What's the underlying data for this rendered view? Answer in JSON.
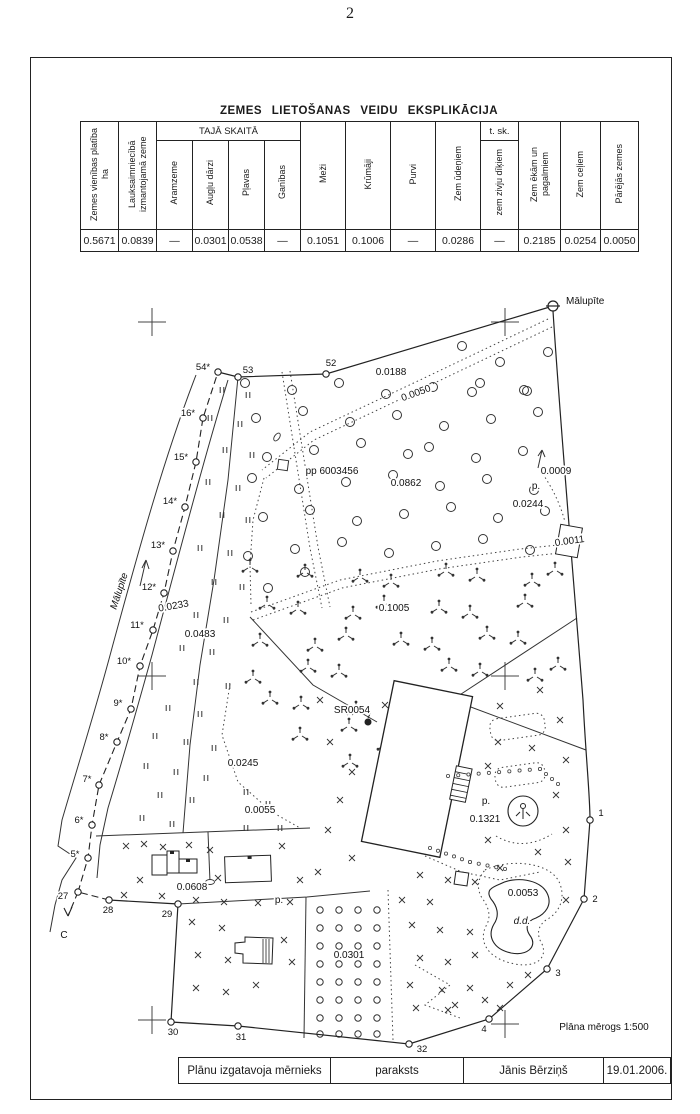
{
  "page": {
    "number": "2"
  },
  "explication": {
    "title": "ZEMES LIETOŠANAS VEIDU EKSPLIKĀCIJA",
    "col_platiba": "Zemes vienības platība ha",
    "col_lauksaimnieciba": "Lauksaimniecībā izmantojamā zeme",
    "group_taja_skaita": "TAJĀ SKAITĀ",
    "col_aramzeme": "Aramzeme",
    "col_auglu_darzi": "Augļu dārzi",
    "col_plavas": "Pļavas",
    "col_ganibas": "Ganības",
    "col_mezi": "Meži",
    "col_krumaji": "Krūmāji",
    "col_purvi": "Purvi",
    "col_zem_udeniem": "Zem ūdeņiem",
    "group_t_sk": "t. sk.",
    "col_zem_zivju": "zem zivju dīķiem",
    "col_zem_ekam": "Zem ēkām un pagalmiem",
    "col_zem_celiem": "Zem ceļiem",
    "col_parejas": "Pārējās zemes",
    "values": [
      "0.5671",
      "0.0839",
      "—",
      "0.0301",
      "0.0538",
      "—",
      "0.1051",
      "0.1006",
      "—",
      "0.0286",
      "—",
      "0.2185",
      "0.0254",
      "0.0050"
    ]
  },
  "map": {
    "scale_note": "Plāna mērogs 1:500",
    "stream_name": "Mālupīte",
    "area_labels": [
      {
        "t": "Mālupīte",
        "x": 566,
        "y": 304,
        "a": "start",
        "s": 11
      },
      {
        "t": "0.0188",
        "x": 391,
        "y": 375
      },
      {
        "t": "0.0050",
        "x": 417,
        "y": 396,
        "r": -20
      },
      {
        "t": "pp 6003456",
        "x": 332,
        "y": 474,
        "a": "middle"
      },
      {
        "t": "0.0862",
        "x": 406,
        "y": 486
      },
      {
        "t": "0.0009",
        "x": 556,
        "y": 474
      },
      {
        "t": "p.",
        "x": 536,
        "y": 489
      },
      {
        "t": "0.0244",
        "x": 528,
        "y": 507
      },
      {
        "t": "0.0011",
        "x": 570,
        "y": 544,
        "r": -8
      },
      {
        "t": "0.1005",
        "x": 394,
        "y": 611
      },
      {
        "t": "0.0233",
        "x": 174,
        "y": 609,
        "r": -10
      },
      {
        "t": "0.0483",
        "x": 200,
        "y": 637
      },
      {
        "t": "SR0054",
        "x": 352,
        "y": 713
      },
      {
        "t": "0.0245",
        "x": 243,
        "y": 766
      },
      {
        "t": "0.0055",
        "x": 260,
        "y": 813
      },
      {
        "t": "p.",
        "x": 486,
        "y": 804
      },
      {
        "t": "0.1321",
        "x": 485,
        "y": 822
      },
      {
        "t": "0.0608",
        "x": 192,
        "y": 890
      },
      {
        "t": "p.",
        "x": 279,
        "y": 903
      },
      {
        "t": "0.0301",
        "x": 349,
        "y": 958
      },
      {
        "t": "0.0053",
        "x": 523,
        "y": 896
      },
      {
        "t": "d.d.",
        "x": 522,
        "y": 924,
        "i": true
      },
      {
        "t": "Mālupīte",
        "x": 122,
        "y": 592,
        "r": -72,
        "i": true,
        "s": 21
      },
      {
        "t": "C",
        "x": 64,
        "y": 938,
        "s": 15
      },
      {
        "t": "Plāna mērogs 1:500",
        "x": 604,
        "y": 1030,
        "s": 10.5
      }
    ],
    "points": [
      {
        "n": "1",
        "cx": 590,
        "cy": 820,
        "lx": 601,
        "ly": 816
      },
      {
        "n": "2",
        "cx": 584,
        "cy": 899,
        "lx": 595,
        "ly": 902
      },
      {
        "n": "3",
        "cx": 547,
        "cy": 969,
        "lx": 558,
        "ly": 976
      },
      {
        "n": "4",
        "cx": 489,
        "cy": 1019,
        "lx": 484,
        "ly": 1032
      },
      {
        "n": "5*",
        "cx": 88,
        "cy": 858,
        "lx": 75,
        "ly": 857
      },
      {
        "n": "6*",
        "cx": 92,
        "cy": 825,
        "lx": 79,
        "ly": 823
      },
      {
        "n": "7*",
        "cx": 99,
        "cy": 785,
        "lx": 87,
        "ly": 782
      },
      {
        "n": "8*",
        "cx": 117,
        "cy": 742,
        "lx": 104,
        "ly": 740
      },
      {
        "n": "9*",
        "cx": 131,
        "cy": 709,
        "lx": 118,
        "ly": 706
      },
      {
        "n": "10*",
        "cx": 140,
        "cy": 666,
        "lx": 124,
        "ly": 664
      },
      {
        "n": "11*",
        "cx": 153,
        "cy": 630,
        "lx": 137,
        "ly": 628
      },
      {
        "n": "12*",
        "cx": 164,
        "cy": 593,
        "lx": 149,
        "ly": 590
      },
      {
        "n": "13*",
        "cx": 173,
        "cy": 551,
        "lx": 158,
        "ly": 548
      },
      {
        "n": "14*",
        "cx": 185,
        "cy": 507,
        "lx": 170,
        "ly": 504
      },
      {
        "n": "15*",
        "cx": 196,
        "cy": 462,
        "lx": 181,
        "ly": 460
      },
      {
        "n": "16*",
        "cx": 203,
        "cy": 418,
        "lx": 188,
        "ly": 416
      },
      {
        "n": "54*",
        "cx": 218,
        "cy": 372,
        "lx": 203,
        "ly": 370
      },
      {
        "n": "53",
        "cx": 238,
        "cy": 377,
        "lx": 248,
        "ly": 373
      },
      {
        "n": "52",
        "cx": 326,
        "cy": 374,
        "lx": 331,
        "ly": 366
      },
      {
        "n": "27",
        "cx": 78,
        "cy": 892,
        "lx": 63,
        "ly": 899
      },
      {
        "n": "28",
        "cx": 109,
        "cy": 900,
        "lx": 108,
        "ly": 913
      },
      {
        "n": "29",
        "cx": 178,
        "cy": 904,
        "lx": 167,
        "ly": 917
      },
      {
        "n": "30",
        "cx": 171,
        "cy": 1022,
        "lx": 173,
        "ly": 1035
      },
      {
        "n": "31",
        "cx": 238,
        "cy": 1026,
        "lx": 241,
        "ly": 1040
      },
      {
        "n": "32",
        "cx": 409,
        "cy": 1044,
        "lx": 422,
        "ly": 1052
      }
    ]
  },
  "footer": {
    "maker": "Plānu izgatavoja mērnieks",
    "signature": "paraksts",
    "name": "Jānis Bērziņš",
    "date": "19.01.2006."
  }
}
